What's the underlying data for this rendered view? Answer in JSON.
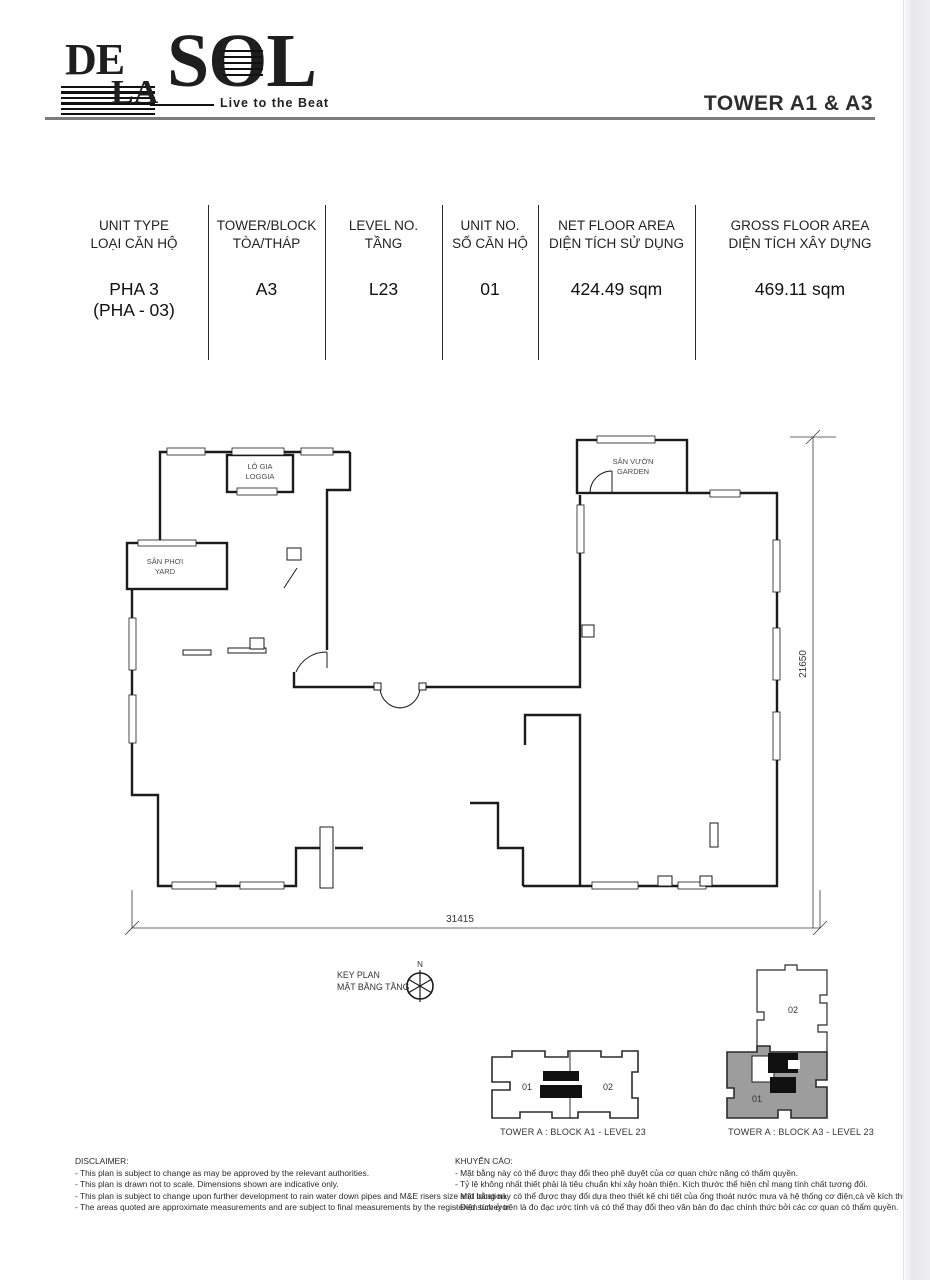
{
  "header": {
    "logo": {
      "de": "DE",
      "la": "LA",
      "sol": "SOL",
      "tagline": "Live to the Beat"
    },
    "tower_title": "TOWER A1 & A3"
  },
  "spec_table": {
    "columns": [
      {
        "en": "UNIT TYPE",
        "vi": "LOẠI CĂN HỘ",
        "value": "PHA 3",
        "value2": "(PHA - 03)"
      },
      {
        "en": "TOWER/BLOCK",
        "vi": "TÒA/THÁP",
        "value": "A3",
        "value2": ""
      },
      {
        "en": "LEVEL NO.",
        "vi": "TẦNG",
        "value": "L23",
        "value2": ""
      },
      {
        "en": "UNIT NO.",
        "vi": "SỐ CĂN HỘ",
        "value": "01",
        "value2": ""
      },
      {
        "en": "NET FLOOR AREA",
        "vi": "DIỆN TÍCH SỬ DỤNG",
        "value": "424.49 sqm",
        "value2": ""
      },
      {
        "en": "GROSS FLOOR AREA",
        "vi": "DIỆN TÍCH XÂY DỰNG",
        "value": "469.11 sqm",
        "value2": ""
      }
    ]
  },
  "floor_plan": {
    "rooms": {
      "loggia_vi": "LÔ GIA",
      "loggia_en": "LOGGIA",
      "yard_vi": "SÂN PHƠI",
      "yard_en": "YARD",
      "garden_vi": "SÂN VƯỜN",
      "garden_en": "GARDEN"
    },
    "dim_width": "31415",
    "dim_height": "21650"
  },
  "key_plan": {
    "title_en": "KEY PLAN",
    "title_vi": "MẶT BẰNG TẦNG",
    "north": "N",
    "block_a1": {
      "caption": "TOWER  A :  BLOCK A1 - LEVEL 23",
      "unit_left": "01",
      "unit_right": "02"
    },
    "block_a3": {
      "caption": "TOWER  A :  BLOCK A3 - LEVEL 23",
      "unit_top": "02",
      "unit_bottom": "01"
    }
  },
  "disclaimer": {
    "title": "DISCLAIMER:",
    "lines": [
      "- This plan is subject to change as may be approved by the relevant authorities.",
      "- This plan is drawn not to scale. Dimensions shown are indicative only.",
      "- This plan is subject to change upon further development to rain water down pipes and M&E risers size and location.",
      "- The areas quoted are approximate measurements and are subject to final measurements by the registered surveyor."
    ]
  },
  "advisory": {
    "title": "KHUYẾN CÁO:",
    "lines": [
      "- Mặt bằng này có thể được thay đổi theo phê duyệt của cơ quan chức năng có thẩm quyền.",
      "- Tỷ lệ không nhất thiết phải là tiêu chuẩn khi xây hoàn thiện. Kích thước thể hiện chỉ mang tính chất tương đối.",
      "- Mặt bằng này có thể được thay đổi dựa theo thiết kế chi tiết của ống thoát nước mưa và hệ thống cơ điện,cả về kích thước và vị trí.",
      "- Diện tích ở trên là đo đạc ước tính và có thể thay đổi theo văn bản đo đạc chính thức bởi các cơ quan có thẩm quyền."
    ]
  },
  "colors": {
    "highlight_gray": "#9d9d9d",
    "line": "#1b1b1b"
  }
}
